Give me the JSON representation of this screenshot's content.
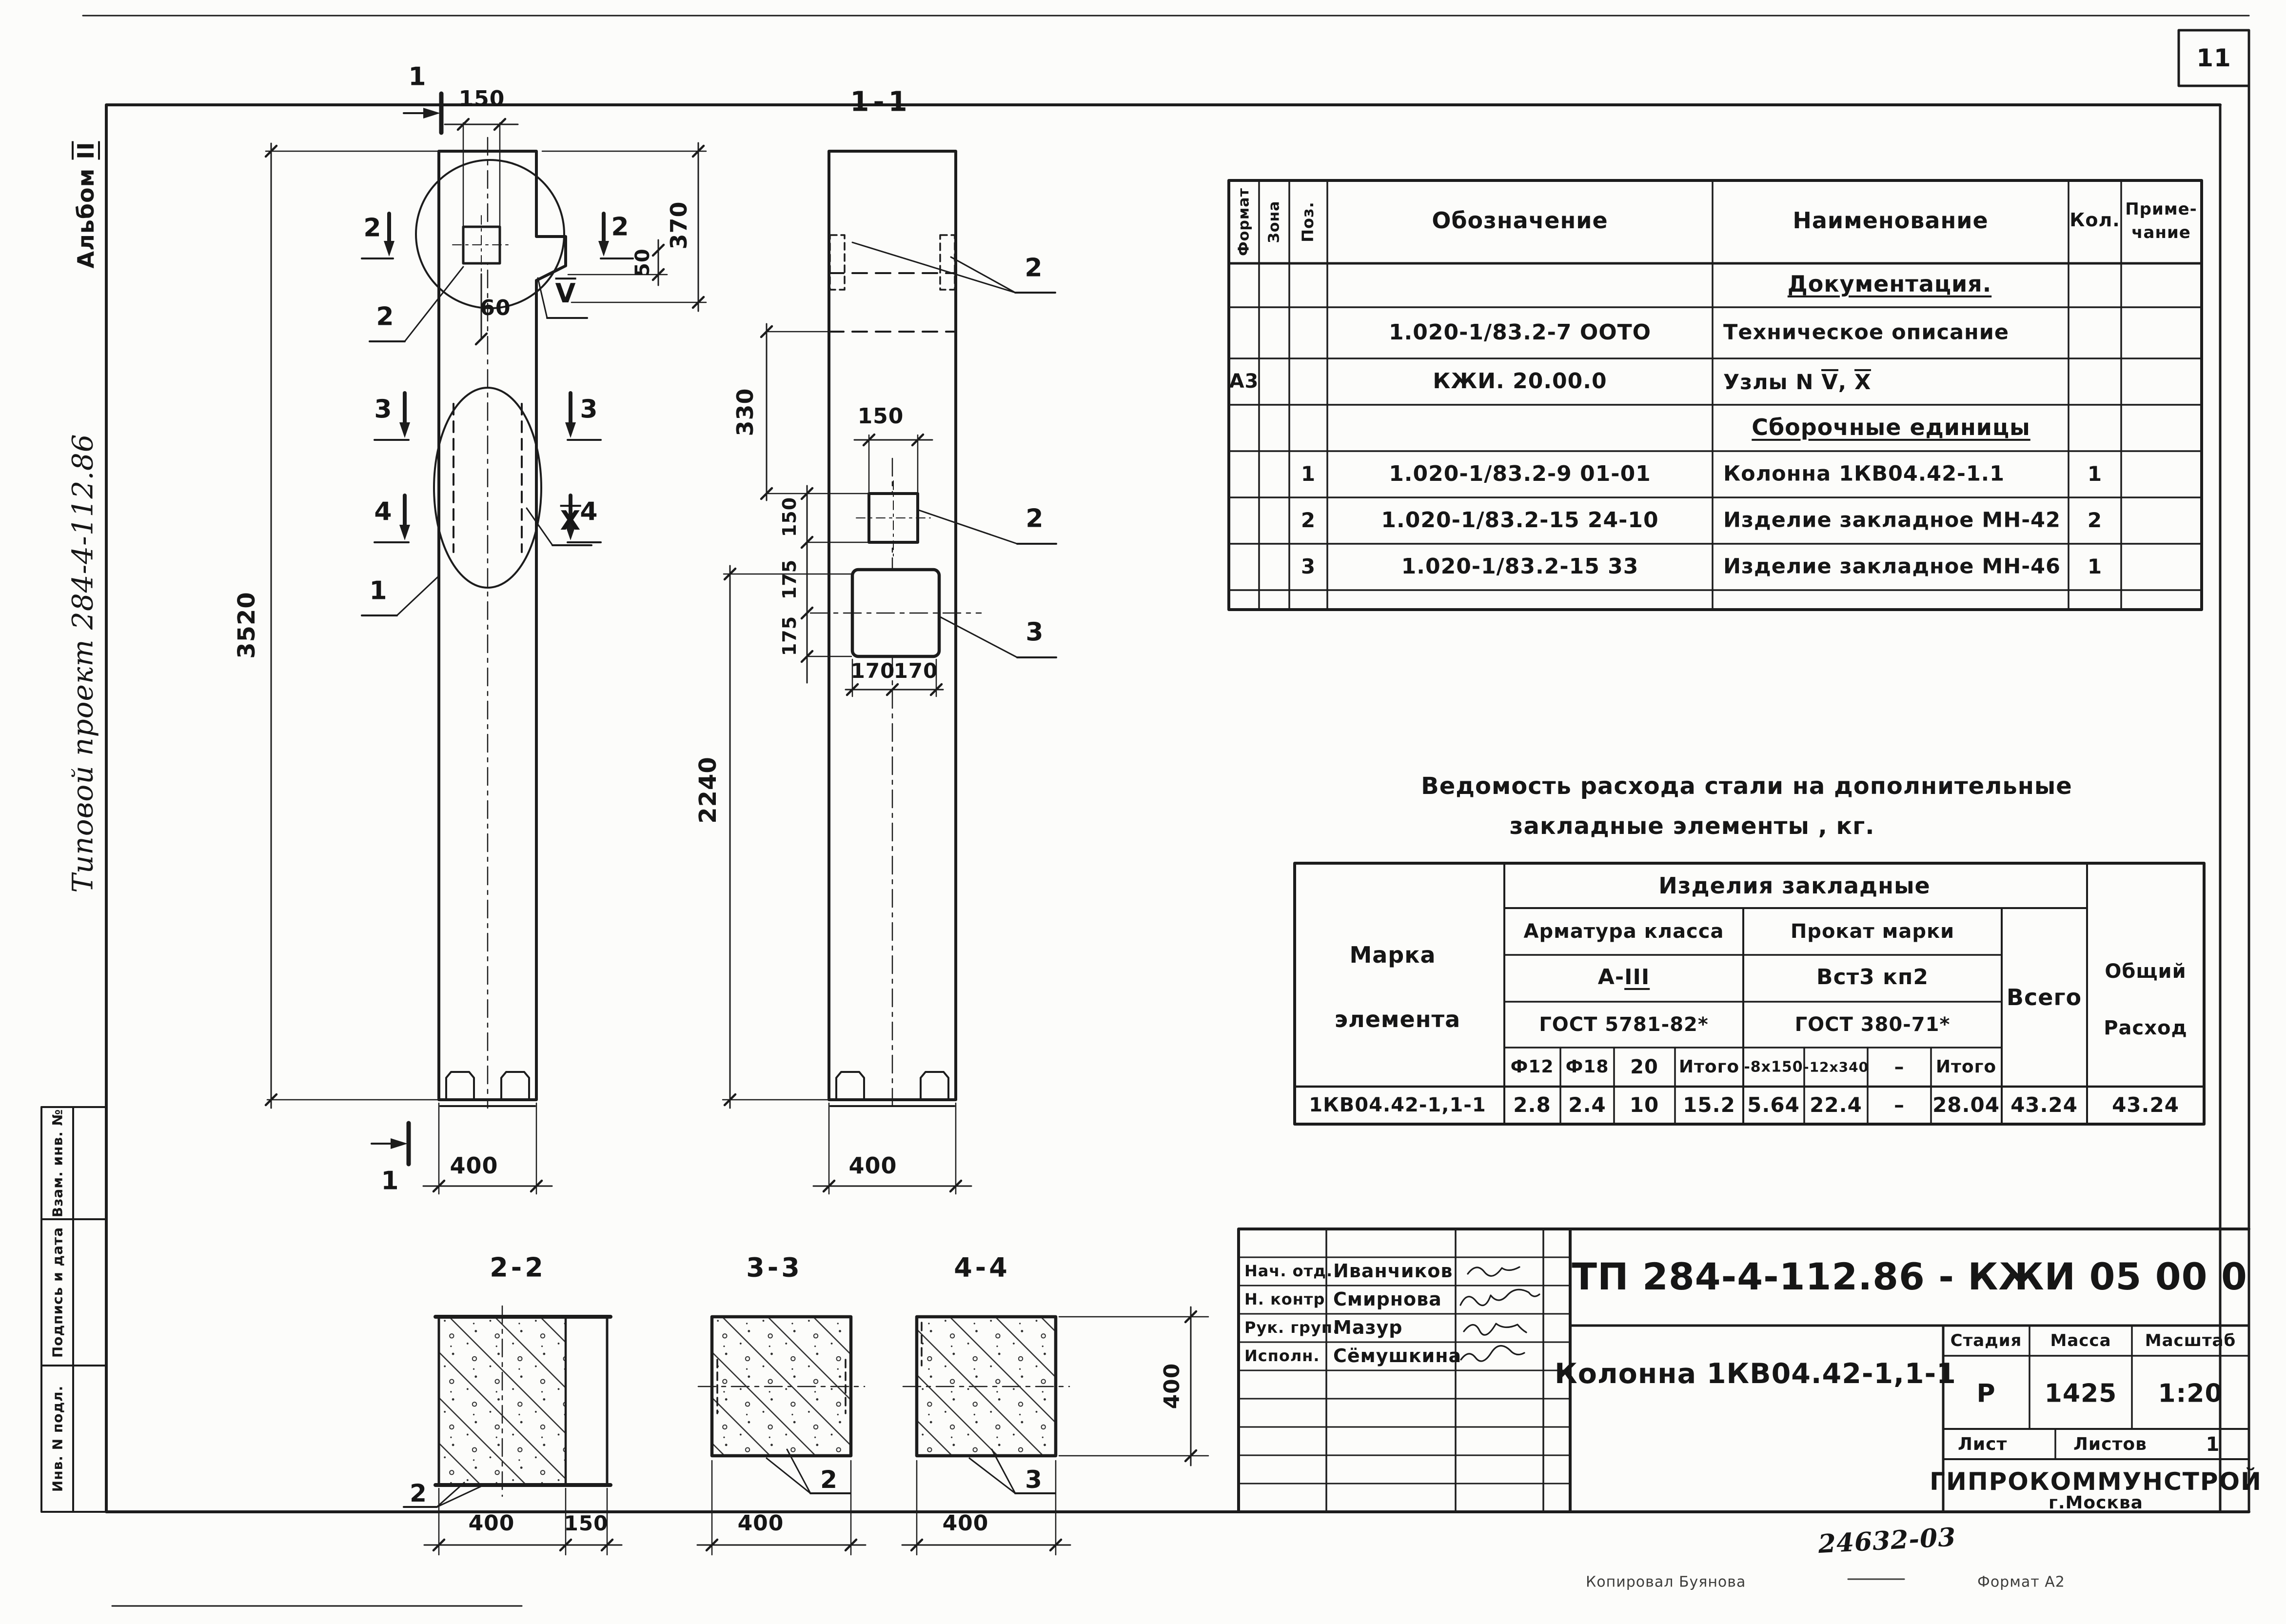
{
  "page": {
    "sheet_number": "11"
  },
  "margins": {
    "album_prefix": "Альбом",
    "album_num": "II",
    "project": "Типовой проект 284-4-112.86",
    "stamp_vzam": "Взам. инв. №",
    "stamp_podpis": "Подпись и дата",
    "stamp_inv": "Инв. N подл."
  },
  "elevation": {
    "dim_150_top": "150",
    "dim_3520": "3520",
    "dim_370": "370",
    "dim_50": "50",
    "dim_60": "60",
    "dim_400": "400",
    "mark_1_top": "1",
    "mark_1_bottom": "1",
    "mark_2_left": "2",
    "mark_2_right": "2",
    "mark_3_left": "3",
    "mark_3_right": "3",
    "mark_4_left": "4",
    "mark_4_right": "4",
    "leader_2": "2",
    "leader_1": "1",
    "node_v": "V",
    "node_x": "X"
  },
  "section11": {
    "title": "1-1",
    "dim_150_plate": "150",
    "dim_150_left": "150",
    "dim_175_a": "175",
    "dim_175_b": "175",
    "dim_330": "330",
    "dim_2240": "2240",
    "dim_170_a": "170",
    "dim_170_b": "170",
    "dim_400": "400",
    "leader_2_top": "2",
    "leader_2_mid": "2",
    "leader_3": "3"
  },
  "cross_sections": {
    "s22": {
      "title": "2-2",
      "dim_400": "400",
      "dim_150": "150",
      "leader": "2"
    },
    "s33": {
      "title": "3-3",
      "dim_400": "400",
      "leader": "2"
    },
    "s44": {
      "title": "4-4",
      "dim_400": "400",
      "dim_400_v": "400",
      "leader": "3"
    }
  },
  "spec_table": {
    "h_format": "Формат",
    "h_zona": "Зона",
    "h_poz": "Поз.",
    "h_oboz": "Обозначение",
    "h_naim": "Наименование",
    "h_kol": "Кол.",
    "h_prim1": "Приме-",
    "h_prim2": "чание",
    "sec_doc": "Документация.",
    "r1_oboz": "1.020-1/83.2-7 ООТО",
    "r1_naim": "Техническое описание",
    "r2_format": "А3",
    "r2_oboz": "КЖИ. 20.00.0",
    "r2_naim_prefix": "Узлы N",
    "r2_node_v": "V",
    "r2_comma": ",",
    "r2_node_x": "X",
    "sec_sbor": "Сборочные единицы",
    "rows": [
      {
        "poz": "1",
        "oboz": "1.020-1/83.2-9  01-01",
        "naim": "Колонна 1КВ04.42-1.1",
        "kol": "1"
      },
      {
        "poz": "2",
        "oboz": "1.020-1/83.2-15  24-10",
        "naim": "Изделие закладное МН-42",
        "kol": "2"
      },
      {
        "poz": "3",
        "oboz": "1.020-1/83.2-15  33",
        "naim": "Изделие закладное МН-46",
        "kol": "1"
      }
    ]
  },
  "steel_table": {
    "title_line1": "Ведомость расхода стали  на дополнительные",
    "title_line2": "закладные элементы , кг.",
    "marka_1": "Марка",
    "marka_2": "элемента",
    "izdeliya": "Изделия закладные",
    "armatura": "Арматура класса",
    "a_class_prefix": "А-",
    "a_class_num": "III",
    "prokat": "Прокат марки",
    "vst": "Вст3 кп2",
    "gost_a": "ГОСТ 5781-82*",
    "gost_p": "ГОСТ 380-71*",
    "sub_f12": "Ф12",
    "sub_f18": "Ф18",
    "sub_20": "20",
    "sub_itogo_a": "Итого",
    "sub_8x150": "-8х150",
    "sub_12x340": "-12х340",
    "sub_dash": "–",
    "sub_itogo_p": "Итого",
    "vsego": "Всего",
    "obshiy_1": "Общий",
    "obshiy_2": "Расход",
    "row_marka": "1КВ04.42-1,1-1",
    "row_values": [
      "2.8",
      "2.4",
      "10",
      "15.2",
      "5.64",
      "22.4",
      "–",
      "28.04",
      "43.24",
      "43.24"
    ]
  },
  "title_block": {
    "doc_number": "ТП 284-4-112.86 - КЖИ 05 00 0",
    "item_name": "Колонна 1КВ04.42-1,1-1",
    "roles": [
      {
        "role": "Нач. отд.",
        "name": "Иванчиков"
      },
      {
        "role": "Н. контр",
        "name": "Смирнова"
      },
      {
        "role": "Рук. груп.",
        "name": "Мазур"
      },
      {
        "role": "Исполн.",
        "name": "Сёмушкина"
      }
    ],
    "h_stadia": "Стадия",
    "h_massa": "Масса",
    "h_masshtab": "Масштаб",
    "stadia": "Р",
    "massa": "1425",
    "masshtab": "1:20",
    "h_list": "Лист",
    "h_listov": "Листов",
    "listov": "1",
    "org_name": "ГИПРОКОММУНСТРОЙ",
    "org_city": "г.Москва",
    "hand_number": "24632-03",
    "footer_kopiroval": "Копировал  Буянова",
    "footer_format": "Формат А2"
  }
}
